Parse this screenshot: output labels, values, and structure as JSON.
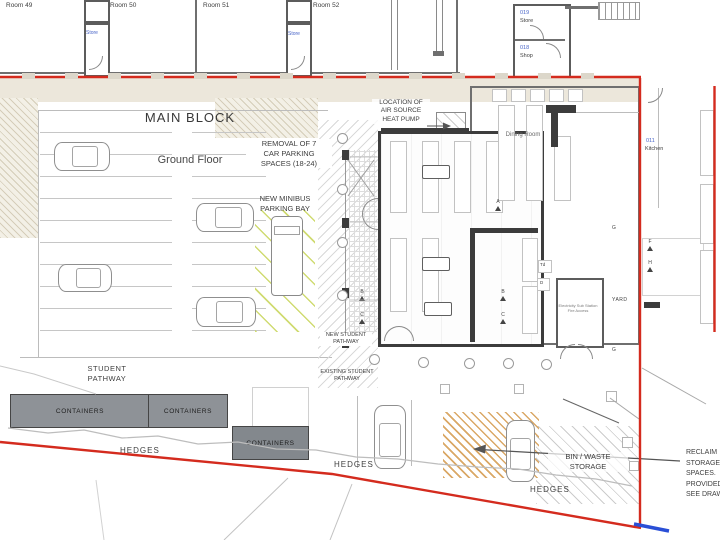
{
  "title": {
    "main": "MAIN BLOCK",
    "sub": "Ground Floor"
  },
  "rooms": {
    "room49": "Room 49",
    "room50": "Room 50",
    "room51": "Room 51",
    "room52": "Room 52",
    "store_a": "Store",
    "store_b": "Store",
    "store019_code": "019",
    "store019_label": "Store",
    "shop018_code": "018",
    "shop018_label": "Shop",
    "dining_room": "Dining Room",
    "kitchen_code": "011",
    "kitchen_label": "Kitchen",
    "substation": "Electricity Sub Station\nFire Access",
    "yard": "YARD"
  },
  "annotations": {
    "removal_parking": "REMOVAL OF 7\nCAR PARKING\nSPACES (18-24)",
    "new_minibus": "NEW MINIBUS\nPARKING BAY",
    "heat_pump": "LOCATION OF\nAIR SOURCE\nHEAT PUMP",
    "new_student_pathway": "NEW STUDENT\nPATHWAY",
    "existing_student_pathway": "EXISTING STUDENT\nPATHWAY",
    "student_pathway": "STUDENT\nPATHWAY",
    "bin_waste": "BIN / WASTE\nSTORAGE",
    "reclaim_note": "RECLAIM\nSTORAGE\nSPACES.\nPROVIDED\nSEE DRAW",
    "hedges1": "HEDGES",
    "hedges2": "HEDGES",
    "hedges3": "HEDGES",
    "containers1": "CONTAINERS",
    "containers2": "CONTAINERS",
    "containers3": "CONTAINERS"
  },
  "markers": {
    "a": "A",
    "b": "B",
    "c": "C",
    "b2": "B",
    "c2": "C",
    "f": "F",
    "h": "H",
    "g1": "G",
    "g2": "G",
    "td": "Td",
    "d": "D"
  },
  "colors": {
    "boundary_red": "#d42b1e",
    "boundary_blue": "#2a4fd6",
    "container_gray": "#8e9297",
    "minibus_yellow": "#cdd96a",
    "reclaim_orange": "#d8a35e",
    "code_blue": "#4a66c8"
  }
}
